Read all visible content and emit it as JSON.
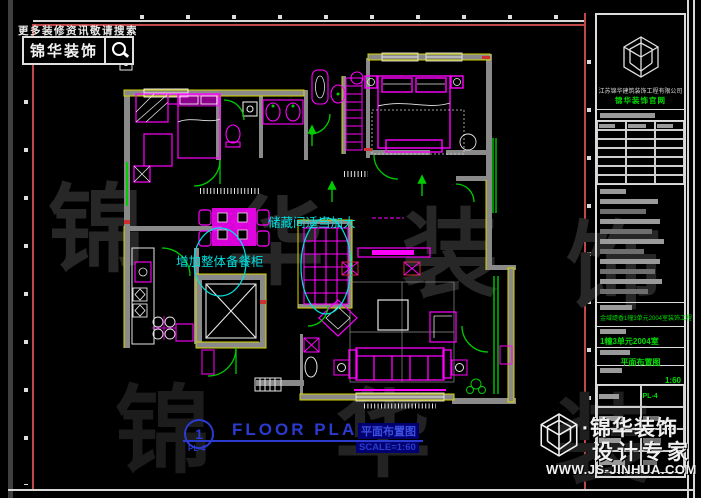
{
  "topbar": {
    "hint": "更多装修资讯敬请搜索",
    "brand": "锦华装饰"
  },
  "watermark": {
    "row1": [
      "锦",
      "华",
      "装",
      "饰"
    ],
    "row2": [
      "锦",
      "华",
      "装"
    ]
  },
  "plan": {
    "annotations": {
      "storage": "储藏间适当加大",
      "cabinet": "增加整体备餐柜"
    }
  },
  "footer": {
    "circle_number": "1",
    "sheet_no": "PL-4",
    "title_en": "FLOOR PLAN",
    "title_cn": "平面布置图",
    "scale": "SCALE=1:60"
  },
  "title_block": {
    "company": "江苏锦华建筑装饰工程有限公司",
    "badge": "锦华装饰官网",
    "project": "金域缇香1幢3单元2004室装饰工程",
    "room": "1幢3单元2004室",
    "drawing_name": "平面布置图",
    "scale": "1:60",
    "sheet_no": "PL-4"
  },
  "brand_badge": {
    "dot": "·",
    "name": "锦华装饰",
    "tagline": "设计专家",
    "url": "WWW.JS-JINHUA.COM"
  },
  "colors": {
    "magenta": "#FF00FF",
    "green": "#00CC00",
    "cyan": "#00E0E0",
    "yellow": "#D6D600",
    "blue": "#2B3BD0",
    "wall_gray": "#8A8A8A",
    "frame_red": "#C04848",
    "watermark_gray": "#272727"
  }
}
